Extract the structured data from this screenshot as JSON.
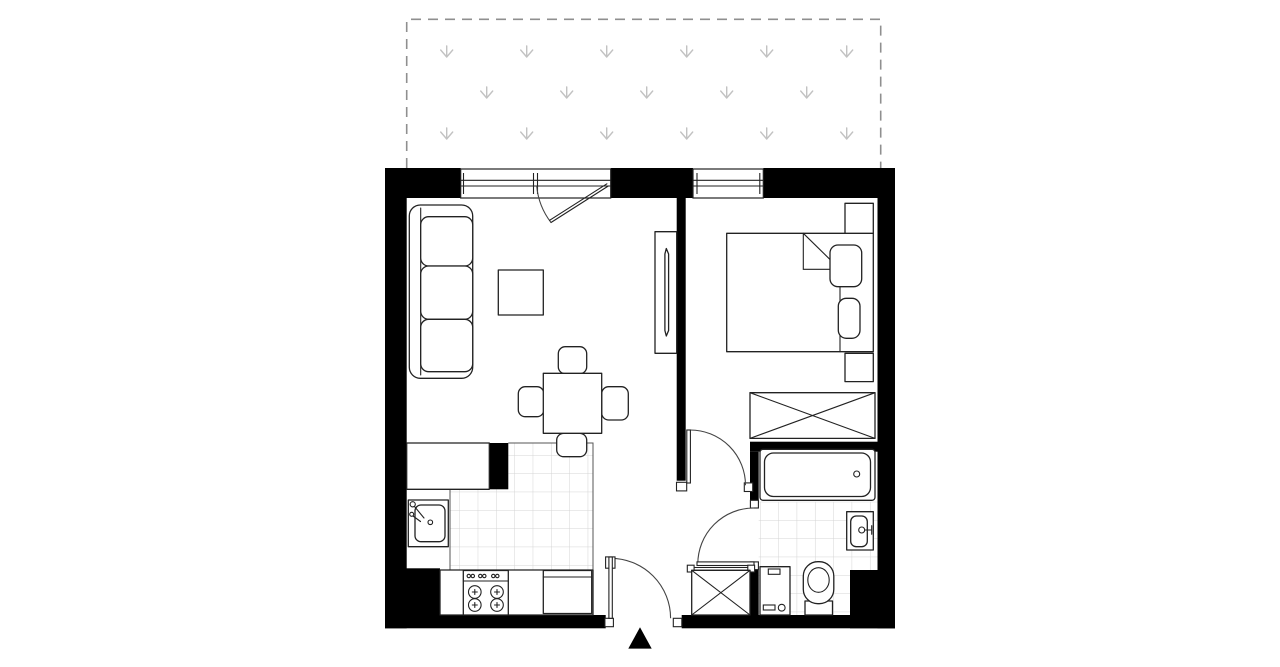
{
  "meta": {
    "kind": "apartment-floor-plan",
    "visible_text": "none"
  },
  "colors": {
    "background": "#ffffff",
    "wall": "#000000",
    "furniture_outline": "#222222",
    "tile_line": "#d4d4d4",
    "terrace_dash": "#8f8f8f",
    "terrace_arrow": "#c2c2c2",
    "door_arc": "#444444",
    "entrance_marker": "#000000"
  },
  "areas": [
    {
      "name": "terrace",
      "features": [
        "dashed-outline",
        "drainage-arrow-grid-3-rows"
      ]
    },
    {
      "name": "living-room-with-kitchenette",
      "furniture": [
        "three-seat-sofa",
        "coffee-table",
        "tv-cabinet",
        "dining-table-with-4-chairs",
        "kitchen-counter",
        "kitchen-sink",
        "stove-4-burners",
        "fridge",
        "tiled-kitchen-floor"
      ]
    },
    {
      "name": "bedroom",
      "furniture": [
        "double-bed-with-folded-blanket",
        "two-pillows",
        "nightstand-top",
        "nightstand-bottom",
        "wardrobe-x-symbol"
      ]
    },
    {
      "name": "bathroom",
      "furniture": [
        "bathtub",
        "wash-basin",
        "toilet",
        "washing-machine",
        "tiled-floor"
      ]
    },
    {
      "name": "hall",
      "furniture": [
        "built-in-closet-x-symbol"
      ]
    }
  ],
  "openings": {
    "windows": [
      "living-room-window-with-balcony-door",
      "bedroom-window"
    ],
    "doors": [
      "entrance-door-bottom",
      "bedroom-door",
      "bathroom-door"
    ],
    "entrance_marker": "black-triangle-pointing-up"
  },
  "terrace_arrows": {
    "rows": [
      {
        "y": 52,
        "xs": [
          446.7,
          526.7,
          606.7,
          686.7,
          766.7,
          846.7
        ]
      },
      {
        "y": 93,
        "xs": [
          486.7,
          566.7,
          646.7,
          726.7,
          806.7
        ]
      },
      {
        "y": 134,
        "xs": [
          446.7,
          526.7,
          606.7,
          686.7,
          766.7,
          846.7
        ]
      }
    ]
  }
}
